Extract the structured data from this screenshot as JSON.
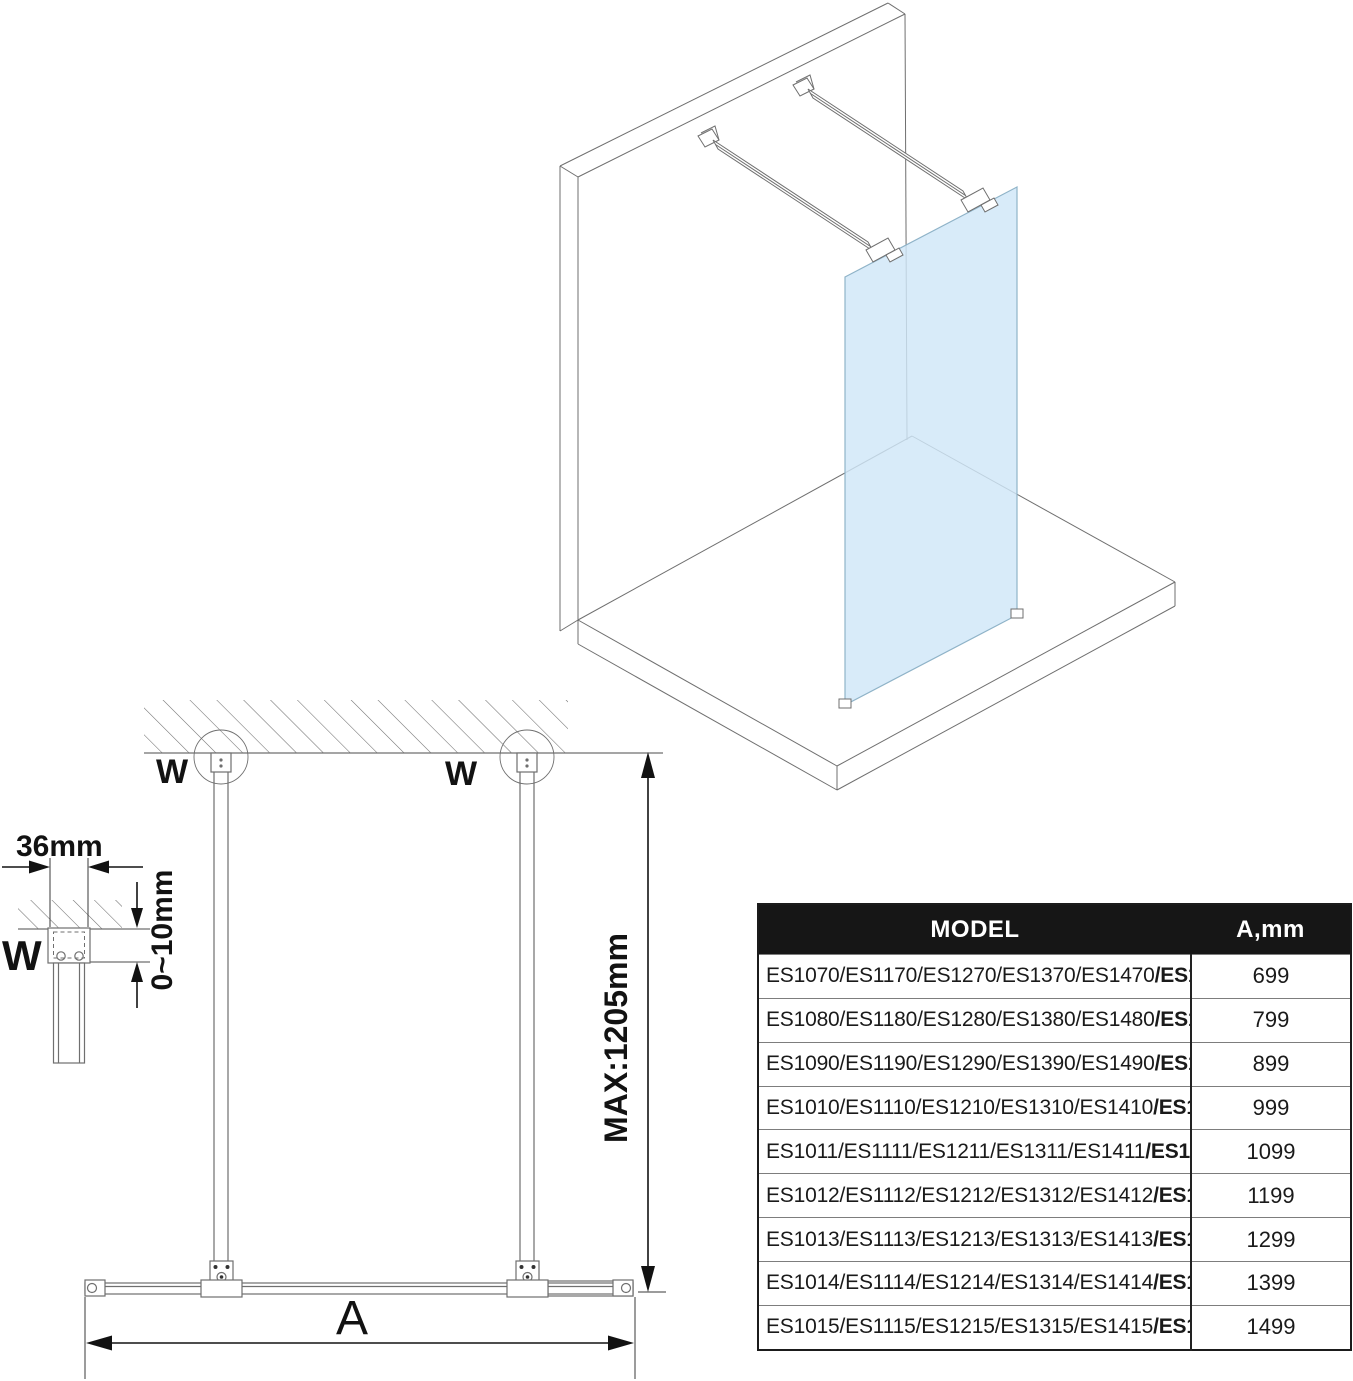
{
  "colors": {
    "glass_fill": "#cfe7f8",
    "glass_edge": "#8fb3c8",
    "drawing_line_gray": "#6f6f6f",
    "dimension_black": "#121212",
    "table_header_bg": "#161616",
    "table_header_text": "#ffffff"
  },
  "plan_view": {
    "labels": {
      "w_left": "W",
      "w_right": "W",
      "a_dim": "A",
      "max_length": "MAX:1205mm"
    }
  },
  "detail_view": {
    "labels": {
      "bracket_width": "36mm",
      "adjust_range": "0~10mm",
      "w_ref": "W"
    }
  },
  "table": {
    "headers": {
      "model": "MODEL",
      "a_mm": "A,mm"
    },
    "rows": [
      {
        "models": "ES1070/ES1170/ES1270/ES1370/ES1470",
        "model_bold": "/ES1570",
        "a": "699"
      },
      {
        "models": "ES1080/ES1180/ES1280/ES1380/ES1480",
        "model_bold": "/ES1580",
        "a": "799"
      },
      {
        "models": "ES1090/ES1190/ES1290/ES1390/ES1490",
        "model_bold": "/ES1590",
        "a": "899"
      },
      {
        "models": "ES1010/ES1110/ES1210/ES1310/ES1410",
        "model_bold": "/ES1510",
        "a": "999"
      },
      {
        "models": "ES1011/ES1111/ES1211/ES1311/ES1411",
        "model_bold": "/ES1511",
        "a": "1099"
      },
      {
        "models": "ES1012/ES1112/ES1212/ES1312/ES1412",
        "model_bold": "/ES1512",
        "a": "1199"
      },
      {
        "models": "ES1013/ES1113/ES1213/ES1313/ES1413",
        "model_bold": "/ES1513",
        "a": "1299"
      },
      {
        "models": "ES1014/ES1114/ES1214/ES1314/ES1414",
        "model_bold": "/ES1514",
        "a": "1399"
      },
      {
        "models": "ES1015/ES1115/ES1215/ES1315/ES1415",
        "model_bold": "/ES1515",
        "a": "1499"
      }
    ]
  }
}
